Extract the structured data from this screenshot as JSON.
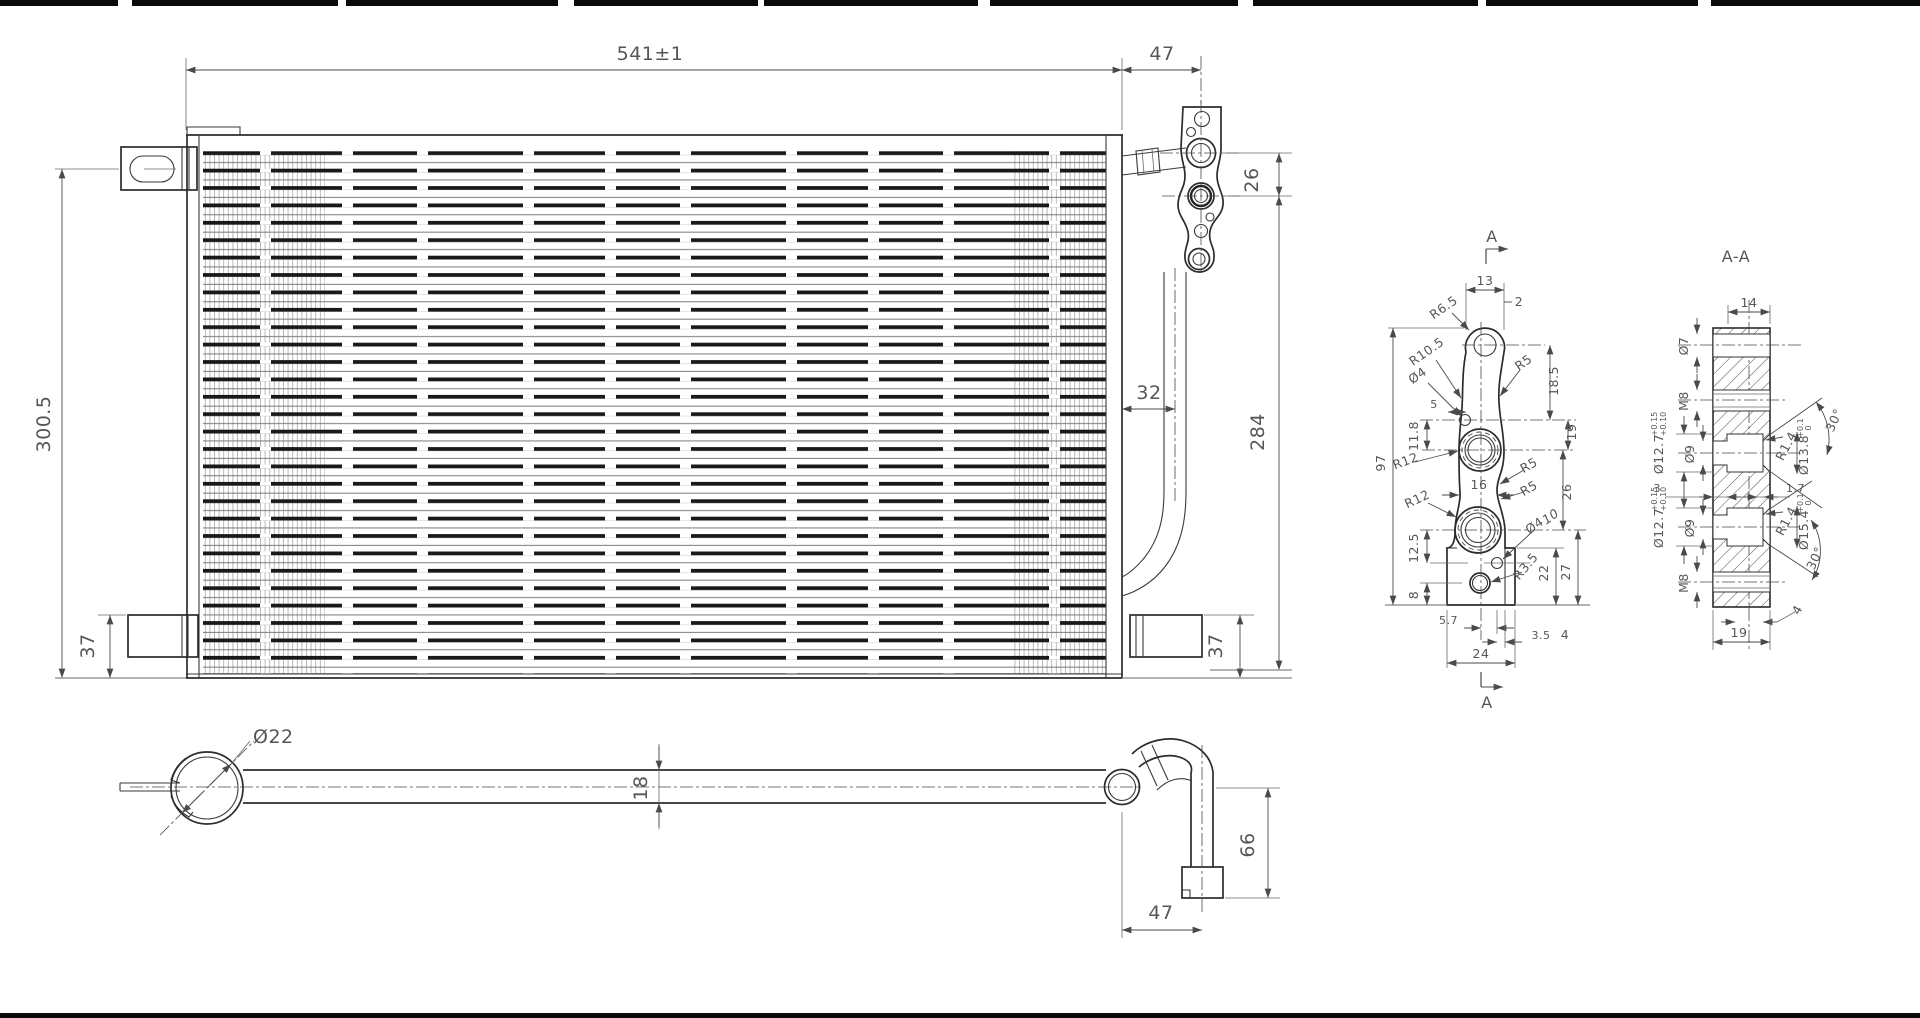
{
  "views": {
    "main": {
      "dims": {
        "width": "541±1",
        "bracket_offset": "47",
        "port_gap": "26",
        "pipe_offset": "32",
        "height_right": "284",
        "height_total": "300.5",
        "bracket_left": "37",
        "bracket_right": "37"
      }
    },
    "bottom": {
      "dims": {
        "tube_dia": "Ø22",
        "tube_height": "18",
        "drop": "66",
        "end_offset": "47"
      }
    },
    "detail_a": {
      "marker_top": "A",
      "marker_bottom": "A",
      "dims": {
        "w13": "13",
        "e2": "2",
        "r65": "R6.5",
        "r105": "R10.5",
        "d4a": "Ø4",
        "r5t": "R5",
        "h185": "18.5",
        "h97": "97",
        "o5": "5",
        "h118": "11.8",
        "r12a": "R12",
        "w16": "16",
        "r5a": "R5",
        "r5b": "R5",
        "h19": "19",
        "h26": "26",
        "r12b": "R12",
        "h125": "12.5",
        "d4b": "Ø4",
        "n10": "10",
        "r35": "R3.5",
        "h8": "8",
        "h22": "22",
        "h27": "27",
        "w57": "5.7",
        "w35": "3.5",
        "w4": "4",
        "w24": "24"
      }
    },
    "section_aa": {
      "title": "A-A",
      "w14": "14",
      "hole7": "Ø7",
      "m8_top": "M8",
      "m8_bot": "M8",
      "depth3": "3",
      "land17": "1.7",
      "wall4": "4",
      "w19": "19",
      "ports": [
        {
          "cb": "Ø12.7",
          "tol_hi": "+0.15",
          "tol_lo": "+0.10",
          "bore": "Ø9",
          "rad": "R1.4",
          "seat": "Ø13.8",
          "stol_hi": "+0.1",
          "stol_lo": "0",
          "angle": "30°"
        },
        {
          "cb": "Ø12.7",
          "tol_hi": "+0.15",
          "tol_lo": "+0.10",
          "bore": "Ø9",
          "rad": "R1.4",
          "seat": "Ø15.4",
          "stol_hi": "+0.1",
          "stol_lo": "0",
          "angle": "30°"
        }
      ]
    }
  }
}
